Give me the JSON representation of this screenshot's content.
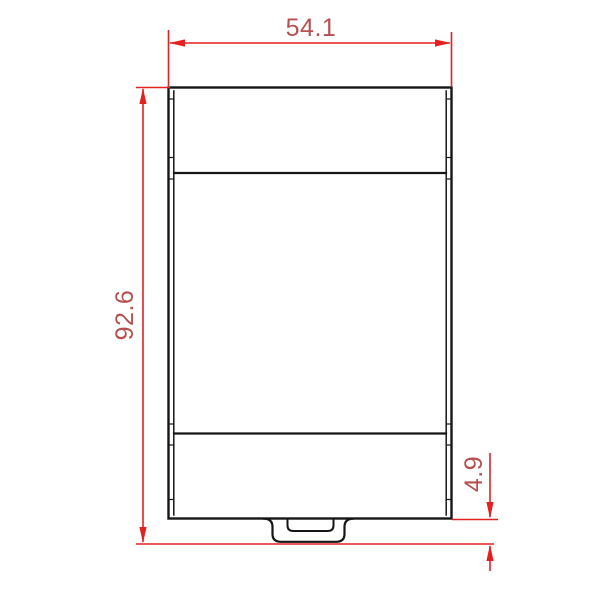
{
  "drawing": {
    "dimensions": {
      "width": {
        "label": "54.1"
      },
      "height": {
        "label": "92.6"
      },
      "tab_depth": {
        "label": "4.9"
      }
    },
    "colors": {
      "dimension_line": "#e32120",
      "dimension_text": "#b5504e",
      "outline": "#161616",
      "background": "#ffffff"
    }
  }
}
